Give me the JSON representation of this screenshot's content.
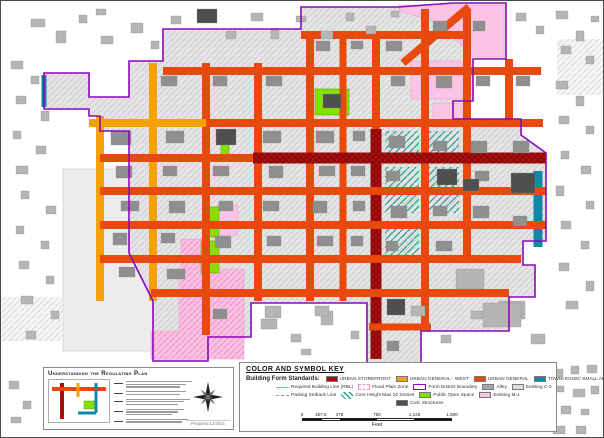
{
  "key": {
    "title": "COLOR AND SYMBOL KEY",
    "standards_label": "Building Form Standards:",
    "standards": [
      {
        "label": "URBAN STOREFRONT",
        "color": "#ab0c10"
      },
      {
        "label": "URBAN GENERAL - WEST",
        "color": "#f5a009"
      },
      {
        "label": "URBAN GENERAL",
        "color": "#e8490f"
      },
      {
        "label": "TOWNHOUSE/ SMALL APT",
        "color": "#0f87a8"
      }
    ],
    "row2": [
      {
        "label": "Required Building Line (RBL)",
        "type": "line",
        "color": "#e8879e"
      },
      {
        "label": "Flood Plain Zone",
        "type": "hatch-pink"
      },
      {
        "label": "Form District Boundary",
        "type": "outline",
        "color": "#8a0ab4"
      },
      {
        "label": "Alley",
        "type": "swatch",
        "color": "#a8a8a8"
      },
      {
        "label": "Existing C-2",
        "type": "swatch",
        "color": "#e0e0e0"
      }
    ],
    "row3": [
      {
        "label": "Parking Setback Line",
        "type": "dashed",
        "color": "#9a9a9a"
      },
      {
        "label": "Core Height Max 10 Stories",
        "type": "hatch-teal"
      },
      {
        "label": "Public Open Space",
        "type": "swatch",
        "color": "#85e000"
      },
      {
        "label": "Existing M-1",
        "type": "swatch",
        "color": "#fbc4e4"
      }
    ],
    "row4": [
      {
        "label": "Civic Structures",
        "type": "swatch",
        "color": "#4f4f4f"
      }
    ],
    "scale": {
      "ticks": [
        "0",
        "187.5",
        "375",
        "750",
        "1,125",
        "1,500"
      ],
      "positions_pct": [
        0,
        12.5,
        25,
        50,
        75,
        100
      ],
      "segments_pct": [
        12.5,
        12.5,
        25,
        25,
        25
      ],
      "unit": "Feet"
    }
  },
  "understanding": {
    "title": "Understanding the Regulating Plan",
    "credits": "Prepared 12/2014",
    "diagram": {
      "streets": [
        {
          "x1": 14,
          "y1": 4,
          "x2": 14,
          "y2": 40,
          "w": 4,
          "c": "storefront"
        },
        {
          "x1": 4,
          "y1": 10,
          "x2": 58,
          "y2": 10,
          "w": 4,
          "c": "general"
        },
        {
          "x1": 30,
          "y1": 4,
          "x2": 30,
          "y2": 18,
          "w": 3,
          "c": "west"
        },
        {
          "x1": 48,
          "y1": 4,
          "x2": 48,
          "y2": 34,
          "w": 3,
          "c": "townhouse"
        },
        {
          "x1": 30,
          "y1": 34,
          "x2": 48,
          "y2": 34,
          "w": 3,
          "c": "townhouse"
        }
      ],
      "park": [
        36,
        22,
        10,
        8
      ]
    }
  },
  "map": {
    "colors": {
      "storefront": "#ab0c10",
      "storefront_dark": "#7c0606",
      "west": "#f5a009",
      "general": "#e8490f",
      "townhouse": "#0f87a8",
      "open_space": "#85e000",
      "open_stroke": "#58a800",
      "m1": "#fbc4e4",
      "m1_line": "#ef9fce",
      "boundary": "#8a0ab4",
      "core": "#1da28e",
      "block": "#e5e5e5",
      "block_line": "#cfcfcf",
      "flood_bg": "#f6f6f6",
      "flood_line": "#d8d8d8",
      "parcel": "#ececec",
      "parcel_line": "#c4c4c4",
      "bld_out": "#b5b5b5",
      "bld_in": "#8f8f8f",
      "civic": "#4f4f4f"
    },
    "boundary_path": "M162,60 L162,28 L300,28 L300,6 L398,6 L452,2 L505,2 L505,58 L472,58 L472,100 L452,100 L452,118 L520,118 L520,134 L545,152 L545,240 L522,240 L522,264 L534,264 L534,296 L508,296 L508,330 L420,330 L420,362 L366,362 L366,302 L250,302 L250,336 L207,336 L207,360 L152,360 L152,300 L128,252 L128,130 L99,130 L99,115 L88,115 L88,108 L43,108 L43,72 L88,72 L88,96 L128,96 L128,60 Z",
    "west_parcel": [
      62,
      168,
      112,
      182
    ],
    "streets": [
      {
        "o": "v",
        "p": 99,
        "a": 115,
        "b": 300,
        "w": 8,
        "c": "west"
      },
      {
        "o": "v",
        "p": 152,
        "a": 62,
        "b": 300,
        "w": 8,
        "c": "west"
      },
      {
        "o": "v",
        "p": 205,
        "a": 62,
        "b": 334,
        "w": 8,
        "c": "general"
      },
      {
        "o": "v",
        "p": 257,
        "a": 62,
        "b": 300,
        "w": 8,
        "c": "general"
      },
      {
        "o": "v",
        "p": 309,
        "a": 32,
        "b": 300,
        "w": 8,
        "c": "general"
      },
      {
        "o": "v",
        "p": 342,
        "a": 32,
        "b": 300,
        "w": 7,
        "c": "general"
      },
      {
        "o": "v",
        "p": 375,
        "a": 32,
        "b": 132,
        "w": 8,
        "c": "general"
      },
      {
        "o": "v",
        "p": 375,
        "a": 128,
        "b": 358,
        "w": 11,
        "c": "storefront"
      },
      {
        "o": "v",
        "p": 424,
        "a": 8,
        "b": 328,
        "w": 8,
        "c": "general"
      },
      {
        "o": "v",
        "p": 466,
        "a": 8,
        "b": 260,
        "w": 8,
        "c": "general"
      },
      {
        "o": "v",
        "p": 508,
        "a": 58,
        "b": 126,
        "w": 8,
        "c": "general"
      },
      {
        "o": "v",
        "p": 537,
        "a": 170,
        "b": 246,
        "w": 9,
        "c": "townhouse"
      },
      {
        "o": "v",
        "p": 43,
        "a": 74,
        "b": 106,
        "w": 5,
        "c": "townhouse"
      },
      {
        "o": "h",
        "p": 34,
        "a": 300,
        "b": 466,
        "w": 8,
        "c": "general"
      },
      {
        "o": "h",
        "p": 70,
        "a": 162,
        "b": 540,
        "w": 8,
        "c": "general"
      },
      {
        "o": "h",
        "p": 122,
        "a": 88,
        "b": 205,
        "w": 8,
        "c": "west"
      },
      {
        "o": "h",
        "p": 122,
        "a": 205,
        "b": 542,
        "w": 8,
        "c": "general"
      },
      {
        "o": "h",
        "p": 157,
        "a": 99,
        "b": 254,
        "w": 8,
        "c": "general"
      },
      {
        "o": "h",
        "p": 157,
        "a": 252,
        "b": 545,
        "w": 11,
        "c": "storefront"
      },
      {
        "o": "h",
        "p": 190,
        "a": 99,
        "b": 545,
        "w": 8,
        "c": "general"
      },
      {
        "o": "h",
        "p": 224,
        "a": 99,
        "b": 545,
        "w": 8,
        "c": "general"
      },
      {
        "o": "h",
        "p": 258,
        "a": 99,
        "b": 520,
        "w": 8,
        "c": "general"
      },
      {
        "o": "h",
        "p": 292,
        "a": 150,
        "b": 508,
        "w": 8,
        "c": "general"
      },
      {
        "o": "h",
        "p": 326,
        "a": 368,
        "b": 430,
        "w": 7,
        "c": "general"
      }
    ],
    "diagonal_street": {
      "x1": 402,
      "y1": 62,
      "x2": 468,
      "y2": 6,
      "w": 8,
      "c": "general"
    },
    "zones": [
      {
        "t": "m1p",
        "pts": "398,4 503,4 503,56 474,56 432,20 398,10"
      },
      {
        "t": "m1",
        "r": [
          410,
          60,
          56,
          38
        ]
      },
      {
        "t": "m1",
        "r": [
          432,
          102,
          32,
          24
        ]
      },
      {
        "t": "m1",
        "r": [
          217,
          204,
          20,
          30
        ]
      },
      {
        "t": "m1h",
        "pts": "178,268 243,268 243,358 150,358 150,330 178,330"
      },
      {
        "t": "m1h",
        "r": [
          180,
          238,
          26,
          30
        ]
      },
      {
        "t": "open",
        "r": [
          314,
          88,
          34,
          26
        ]
      },
      {
        "t": "open",
        "r": [
          204,
          206,
          14,
          30
        ]
      },
      {
        "t": "open",
        "r": [
          200,
          240,
          18,
          32
        ]
      },
      {
        "t": "open",
        "r": [
          220,
          140,
          8,
          14
        ]
      },
      {
        "t": "core",
        "r": [
          384,
          130,
          34,
          24
        ]
      },
      {
        "t": "core",
        "r": [
          424,
          130,
          34,
          24
        ]
      },
      {
        "t": "core",
        "r": [
          384,
          166,
          34,
          46
        ]
      },
      {
        "t": "core",
        "r": [
          424,
          166,
          34,
          46
        ]
      },
      {
        "t": "core",
        "r": [
          384,
          220,
          34,
          36
        ]
      },
      {
        "t": "flood",
        "r": [
          556,
          38,
          46,
          56
        ]
      },
      {
        "t": "flood",
        "r": [
          0,
          296,
          62,
          44
        ]
      }
    ],
    "buildings": [
      [
        30,
        18,
        14,
        8,
        "l"
      ],
      [
        55,
        30,
        10,
        12,
        "l"
      ],
      [
        78,
        14,
        8,
        8,
        "l"
      ],
      [
        100,
        35,
        12,
        8,
        "l"
      ],
      [
        95,
        8,
        10,
        6,
        "l"
      ],
      [
        130,
        22,
        12,
        10,
        "l"
      ],
      [
        150,
        40,
        8,
        8,
        "l"
      ],
      [
        170,
        15,
        10,
        8,
        "l"
      ],
      [
        196,
        8,
        20,
        14,
        "d"
      ],
      [
        225,
        30,
        10,
        8,
        "l"
      ],
      [
        250,
        12,
        12,
        8,
        "l"
      ],
      [
        270,
        28,
        8,
        10,
        "l"
      ],
      [
        295,
        15,
        10,
        6,
        "l"
      ],
      [
        320,
        30,
        12,
        8,
        "l"
      ],
      [
        345,
        12,
        8,
        8,
        "l"
      ],
      [
        365,
        25,
        10,
        8,
        "l"
      ],
      [
        390,
        10,
        8,
        6,
        "l"
      ],
      [
        515,
        12,
        10,
        8,
        "l"
      ],
      [
        535,
        25,
        8,
        8,
        "l"
      ],
      [
        555,
        10,
        12,
        8,
        "l"
      ],
      [
        575,
        30,
        8,
        10,
        "l"
      ],
      [
        590,
        15,
        8,
        6,
        "l"
      ],
      [
        560,
        45,
        10,
        8,
        "l"
      ],
      [
        585,
        55,
        8,
        8,
        "l"
      ],
      [
        555,
        80,
        12,
        8,
        "l"
      ],
      [
        575,
        95,
        8,
        10,
        "l"
      ],
      [
        558,
        115,
        10,
        8,
        "l"
      ],
      [
        585,
        125,
        8,
        8,
        "l"
      ],
      [
        560,
        150,
        8,
        8,
        "l"
      ],
      [
        580,
        165,
        10,
        8,
        "l"
      ],
      [
        555,
        185,
        8,
        10,
        "l"
      ],
      [
        585,
        200,
        8,
        8,
        "l"
      ],
      [
        560,
        220,
        10,
        8,
        "l"
      ],
      [
        580,
        240,
        8,
        8,
        "l"
      ],
      [
        558,
        262,
        10,
        8,
        "l"
      ],
      [
        585,
        280,
        8,
        10,
        "l"
      ],
      [
        565,
        300,
        12,
        8,
        "l"
      ],
      [
        10,
        60,
        12,
        8,
        "l"
      ],
      [
        30,
        75,
        8,
        8,
        "l"
      ],
      [
        15,
        95,
        10,
        8,
        "l"
      ],
      [
        40,
        110,
        8,
        10,
        "l"
      ],
      [
        12,
        130,
        8,
        8,
        "l"
      ],
      [
        35,
        145,
        10,
        8,
        "l"
      ],
      [
        15,
        165,
        12,
        8,
        "l"
      ],
      [
        20,
        190,
        8,
        8,
        "l"
      ],
      [
        45,
        205,
        10,
        8,
        "l"
      ],
      [
        15,
        225,
        8,
        8,
        "l"
      ],
      [
        40,
        240,
        8,
        8,
        "l"
      ],
      [
        18,
        260,
        10,
        8,
        "l"
      ],
      [
        45,
        275,
        8,
        8,
        "l"
      ],
      [
        20,
        295,
        12,
        8,
        "l"
      ],
      [
        50,
        310,
        8,
        8,
        "l"
      ],
      [
        25,
        330,
        10,
        8,
        "l"
      ],
      [
        260,
        318,
        16,
        10,
        "l"
      ],
      [
        290,
        333,
        10,
        8,
        "l"
      ],
      [
        320,
        310,
        12,
        14,
        "l"
      ],
      [
        350,
        330,
        8,
        8,
        "l"
      ],
      [
        410,
        305,
        14,
        10,
        "l"
      ],
      [
        440,
        334,
        10,
        8,
        "l"
      ],
      [
        470,
        310,
        12,
        8,
        "l"
      ],
      [
        498,
        300,
        26,
        18,
        "l"
      ],
      [
        530,
        333,
        14,
        10,
        "l"
      ],
      [
        300,
        348,
        10,
        6,
        "l"
      ],
      [
        455,
        268,
        28,
        20,
        "l"
      ],
      [
        482,
        302,
        38,
        24,
        "l"
      ],
      [
        264,
        305,
        16,
        12,
        "l"
      ],
      [
        314,
        305,
        14,
        10,
        "l"
      ],
      [
        552,
        368,
        10,
        8,
        "l"
      ],
      [
        570,
        365,
        8,
        8,
        "l"
      ],
      [
        586,
        364,
        10,
        8,
        "l"
      ],
      [
        555,
        385,
        8,
        6,
        "l"
      ],
      [
        572,
        388,
        12,
        8,
        "l"
      ],
      [
        590,
        385,
        8,
        8,
        "l"
      ],
      [
        560,
        405,
        10,
        8,
        "l"
      ],
      [
        580,
        408,
        8,
        6,
        "l"
      ],
      [
        552,
        425,
        12,
        8,
        "l"
      ],
      [
        575,
        425,
        10,
        8,
        "l"
      ],
      [
        8,
        380,
        10,
        8,
        "l"
      ],
      [
        22,
        400,
        8,
        8,
        "l"
      ],
      [
        10,
        416,
        10,
        6,
        "l"
      ],
      [
        110,
        130,
        20,
        14,
        "m"
      ],
      [
        115,
        165,
        16,
        12,
        "m"
      ],
      [
        120,
        200,
        18,
        10,
        "m"
      ],
      [
        112,
        232,
        14,
        12,
        "m"
      ],
      [
        118,
        266,
        16,
        10,
        "m"
      ],
      [
        160,
        75,
        16,
        10,
        "m"
      ],
      [
        165,
        130,
        18,
        12,
        "m"
      ],
      [
        162,
        165,
        14,
        10,
        "m"
      ],
      [
        168,
        200,
        16,
        12,
        "m"
      ],
      [
        160,
        232,
        14,
        10,
        "m"
      ],
      [
        166,
        268,
        18,
        10,
        "m"
      ],
      [
        212,
        75,
        14,
        10,
        "m"
      ],
      [
        212,
        165,
        16,
        10,
        "m"
      ],
      [
        218,
        200,
        14,
        10,
        "m"
      ],
      [
        214,
        235,
        16,
        12,
        "m"
      ],
      [
        212,
        308,
        14,
        10,
        "m"
      ],
      [
        265,
        75,
        16,
        10,
        "m"
      ],
      [
        262,
        130,
        18,
        12,
        "m"
      ],
      [
        268,
        165,
        14,
        12,
        "m"
      ],
      [
        262,
        200,
        16,
        10,
        "m"
      ],
      [
        266,
        235,
        14,
        10,
        "m"
      ],
      [
        315,
        40,
        14,
        10,
        "m"
      ],
      [
        315,
        130,
        18,
        12,
        "m"
      ],
      [
        318,
        165,
        16,
        10,
        "m"
      ],
      [
        312,
        200,
        14,
        12,
        "m"
      ],
      [
        316,
        235,
        16,
        10,
        "m"
      ],
      [
        350,
        40,
        12,
        8,
        "m"
      ],
      [
        352,
        130,
        12,
        10,
        "m"
      ],
      [
        350,
        165,
        14,
        10,
        "m"
      ],
      [
        352,
        200,
        12,
        10,
        "m"
      ],
      [
        350,
        235,
        12,
        10,
        "m"
      ],
      [
        385,
        40,
        16,
        10,
        "m"
      ],
      [
        390,
        75,
        14,
        10,
        "m"
      ],
      [
        388,
        135,
        16,
        12,
        "m"
      ],
      [
        385,
        170,
        14,
        10,
        "m"
      ],
      [
        390,
        205,
        16,
        12,
        "m"
      ],
      [
        385,
        240,
        12,
        10,
        "m"
      ],
      [
        386,
        340,
        12,
        10,
        "m"
      ],
      [
        432,
        20,
        14,
        10,
        "m"
      ],
      [
        435,
        75,
        16,
        12,
        "m"
      ],
      [
        432,
        140,
        14,
        10,
        "m"
      ],
      [
        432,
        205,
        14,
        10,
        "m"
      ],
      [
        435,
        240,
        16,
        10,
        "m"
      ],
      [
        472,
        20,
        12,
        10,
        "m"
      ],
      [
        475,
        75,
        14,
        10,
        "m"
      ],
      [
        470,
        140,
        16,
        12,
        "m"
      ],
      [
        474,
        170,
        14,
        10,
        "m"
      ],
      [
        472,
        205,
        16,
        12,
        "m"
      ],
      [
        515,
        75,
        14,
        10,
        "m"
      ],
      [
        512,
        140,
        16,
        12,
        "m"
      ],
      [
        512,
        215,
        14,
        10,
        "m"
      ],
      [
        215,
        128,
        20,
        16,
        "d"
      ],
      [
        322,
        93,
        18,
        14,
        "d"
      ],
      [
        436,
        168,
        20,
        16,
        "d"
      ],
      [
        510,
        172,
        24,
        20,
        "d"
      ],
      [
        386,
        298,
        18,
        16,
        "d"
      ],
      [
        462,
        178,
        16,
        12,
        "d"
      ]
    ]
  }
}
